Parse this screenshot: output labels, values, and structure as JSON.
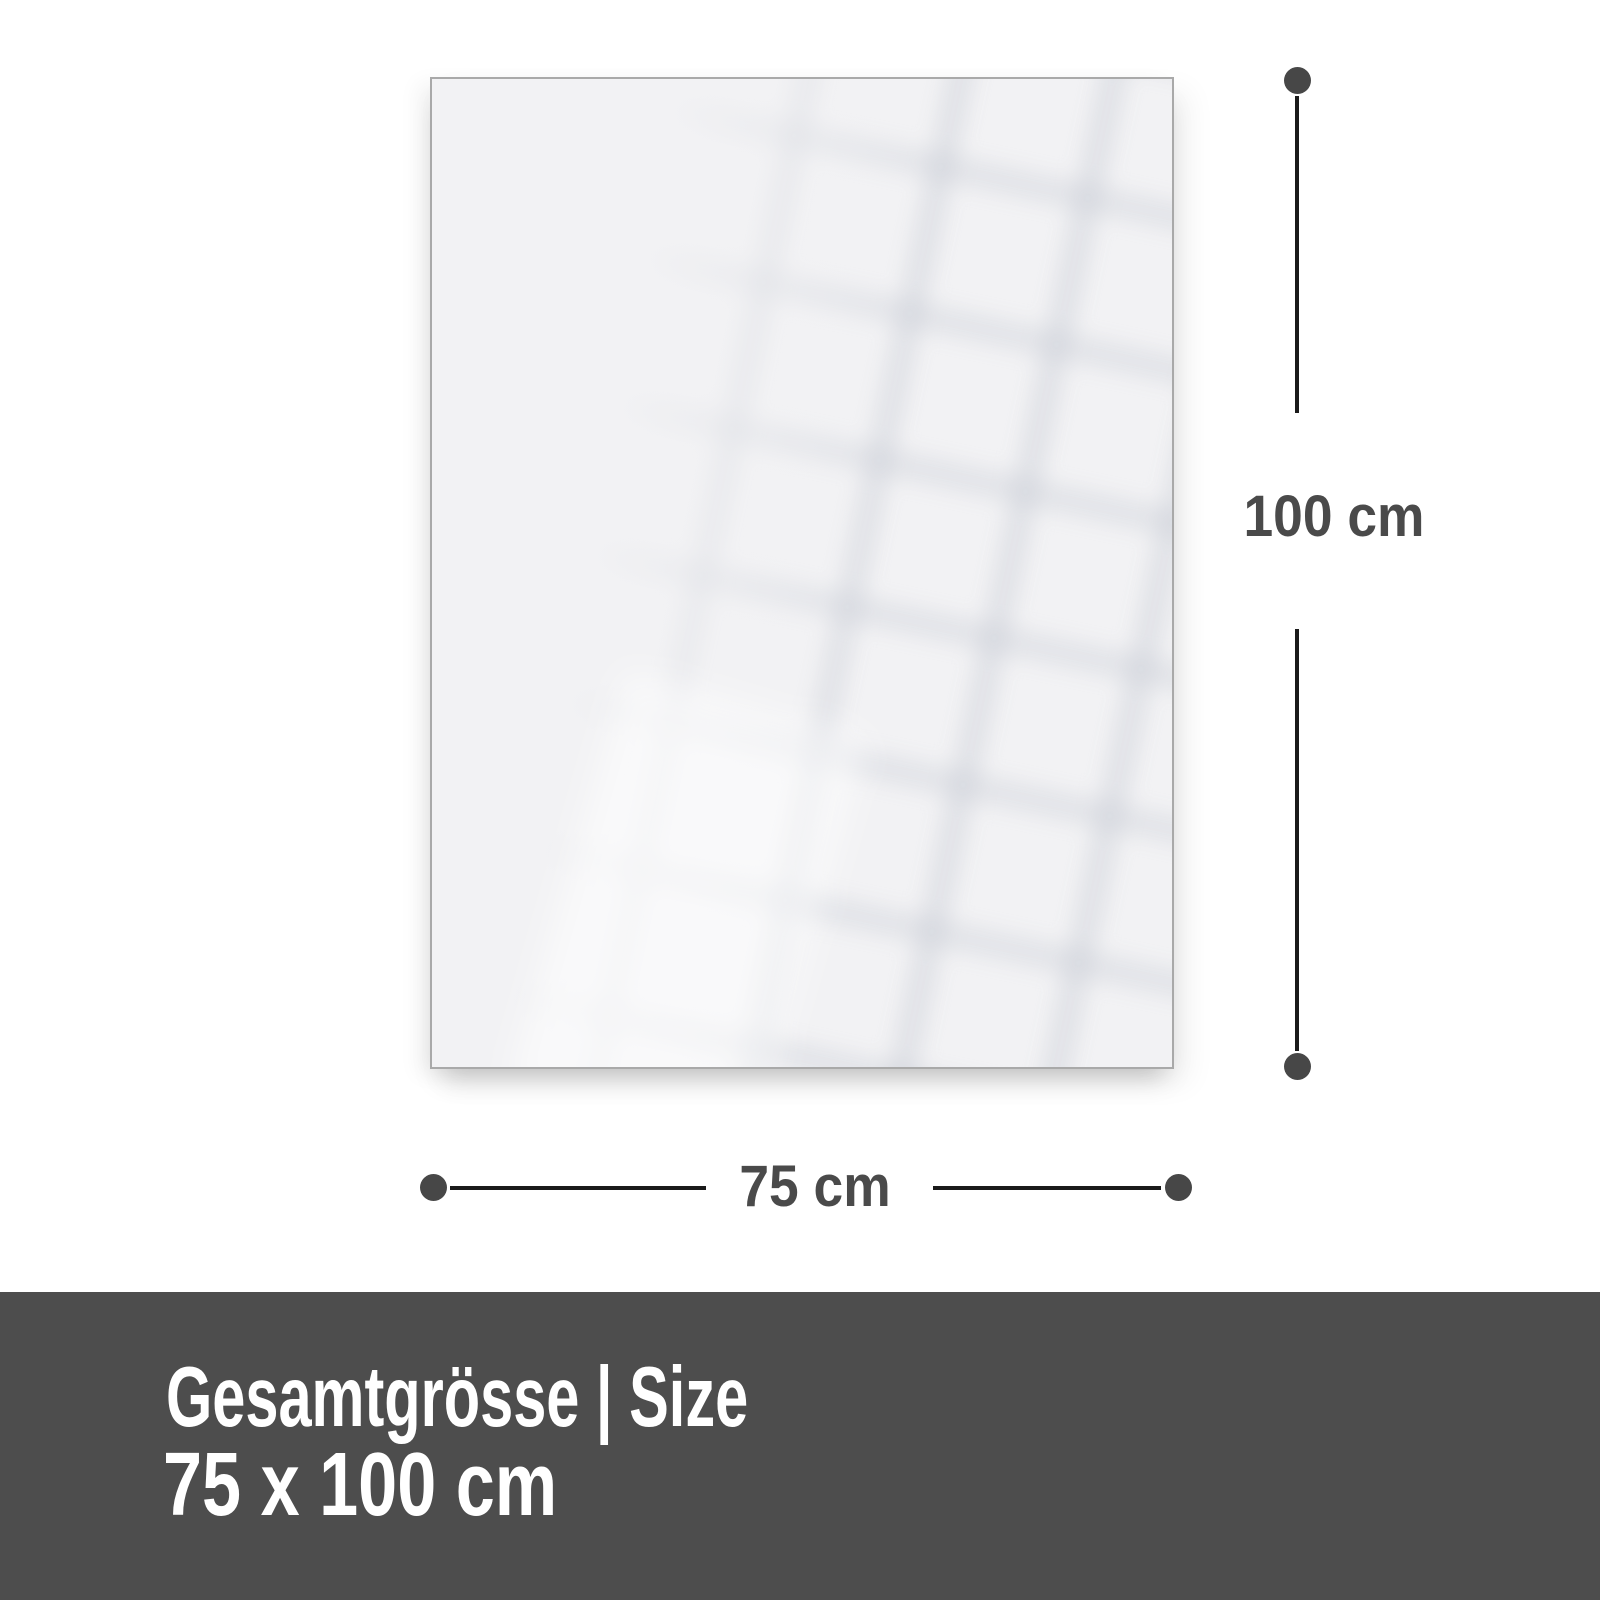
{
  "panel": {
    "description": "blank glossy panel with faint window-grid reflection"
  },
  "dimensions": {
    "height_label": "100 cm",
    "width_label": "75 cm"
  },
  "banner": {
    "title": "Gesamtgrösse | Size",
    "size_value": "75 x 100 cm"
  },
  "colors": {
    "banner_bg": "#4d4d4d",
    "banner_text": "#ffffff",
    "label_text": "#4a4a4a",
    "line": "#1a1a1a",
    "dot": "#474747",
    "panel_fill": "#f2f2f4",
    "panel_border": "#a9a9a9",
    "page_bg": "#ffffff"
  }
}
